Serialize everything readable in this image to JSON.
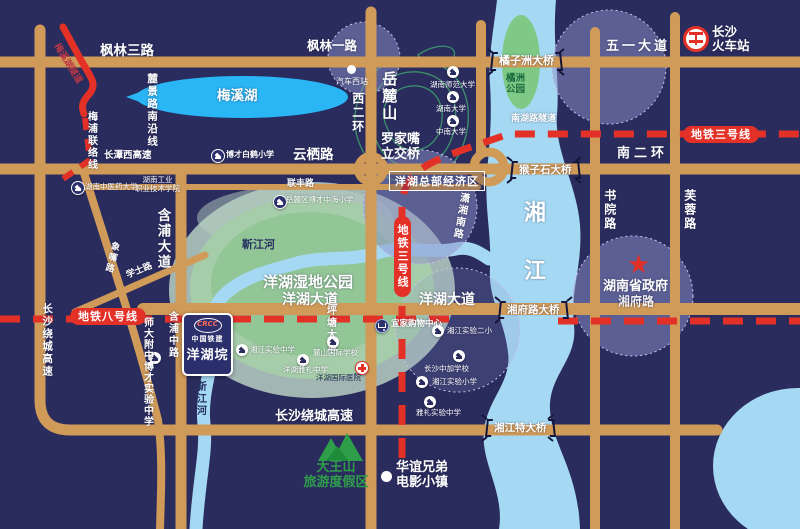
{
  "colors": {
    "bg": "#2a2c5e",
    "road": "#d09a58",
    "river": "#a5d9f3",
    "lake": "#2ab5f5",
    "park_green": "#93c697",
    "metro_red": "#e33128",
    "zone_purple": "#8d91c9",
    "island_green": "#7fc986",
    "mountain_green": "#2f9e4a"
  },
  "station": {
    "name1": "长沙",
    "name2": "火车站"
  },
  "metro": {
    "line3": "地铁三号线",
    "line8": "地铁八号线"
  },
  "roads": {
    "fenglin3": "枫林三路",
    "fenglin1": "枫林一路",
    "wuyi": "五一大道",
    "yunqi": "云栖路",
    "lianfeng": "联丰路",
    "changtanxi": "长潭西高速",
    "nanerhuan": "南二环",
    "nanhu_tunnel": "南湖路隧道",
    "xierhuan": "西二环",
    "hanpu_ave": "含浦大道",
    "hanpu_mid": "含浦中路",
    "xiangzui": "象嘴路",
    "xueshi": "学士路",
    "pingtang": "坪塘大道",
    "shuyuan": "书院路",
    "furong": "芙蓉路",
    "xiaoxiang": "潇湘南路",
    "yanghu_ave": "洋湖大道",
    "yanghu_ave_e": "洋湖大道",
    "xiangfu": "湘府路",
    "raocheng_s": "长沙绕城高速",
    "raocheng_w": "长沙绕城高速",
    "lujing": "麓景路南沿线",
    "meipu": "梅浦联络线",
    "meixihu_tunnel": "梅溪湖隧道"
  },
  "bridges": {
    "juzizhou": "橘子洲大桥",
    "houzishi": "猴子石大桥",
    "xiangfu": "湘府路大桥",
    "xiangjiang": "湘江特大桥"
  },
  "interchange": {
    "line1": "罗家嘴",
    "line2": "立交桥"
  },
  "water": {
    "xiangjiang1": "湘",
    "xiangjiang2": "江",
    "meixi": "梅溪湖",
    "jinjiang": "靳江河",
    "jinjiang_v": "靳江河",
    "juzhou1": "橘洲",
    "juzhou2": "公园"
  },
  "areas": {
    "yuelushan": "岳麓山",
    "wetland": "洋湖湿地公园",
    "cbd": "洋湖总部经济区",
    "gov": "湖南省政府",
    "gov_road": "湘府路",
    "dawangshan1": "大王山",
    "dawangshan2": "旅游度假区",
    "huayi1": "华谊兄弟",
    "huayi2": "电影小镇"
  },
  "pois": {
    "bocai_baihe": "博才白鹤小学",
    "qichexizhan": "汽车西站",
    "hunan_normal": "湖南师范大学",
    "hunan_univ": "湖南大学",
    "central_south": "中南大学",
    "tcm_univ": "湖南中医药大学",
    "hngy1": "湖南工业",
    "hngy2": "职业技术学院",
    "bocai_zhonghai": "岳麓区博才中海小学",
    "shida": "师大附中博才实验中学",
    "xj_exp_mid": "湘江实验中学",
    "lushan": "麓山国际学校",
    "yanghu_yali": "洋湖雅礼中学",
    "hospital": "洋湖国际医院",
    "ikea": "宜家购物中心",
    "xj_exp2": "湘江实验二小",
    "zhongjia": "长沙中加学校",
    "xj_exp_pri": "湘江实验小学",
    "yali_exp": "雅礼实验中学"
  },
  "project": {
    "logo": "CRCC",
    "brand": "中国铁建",
    "name": "洋湖垸"
  },
  "symbols": {
    "star": "★"
  }
}
